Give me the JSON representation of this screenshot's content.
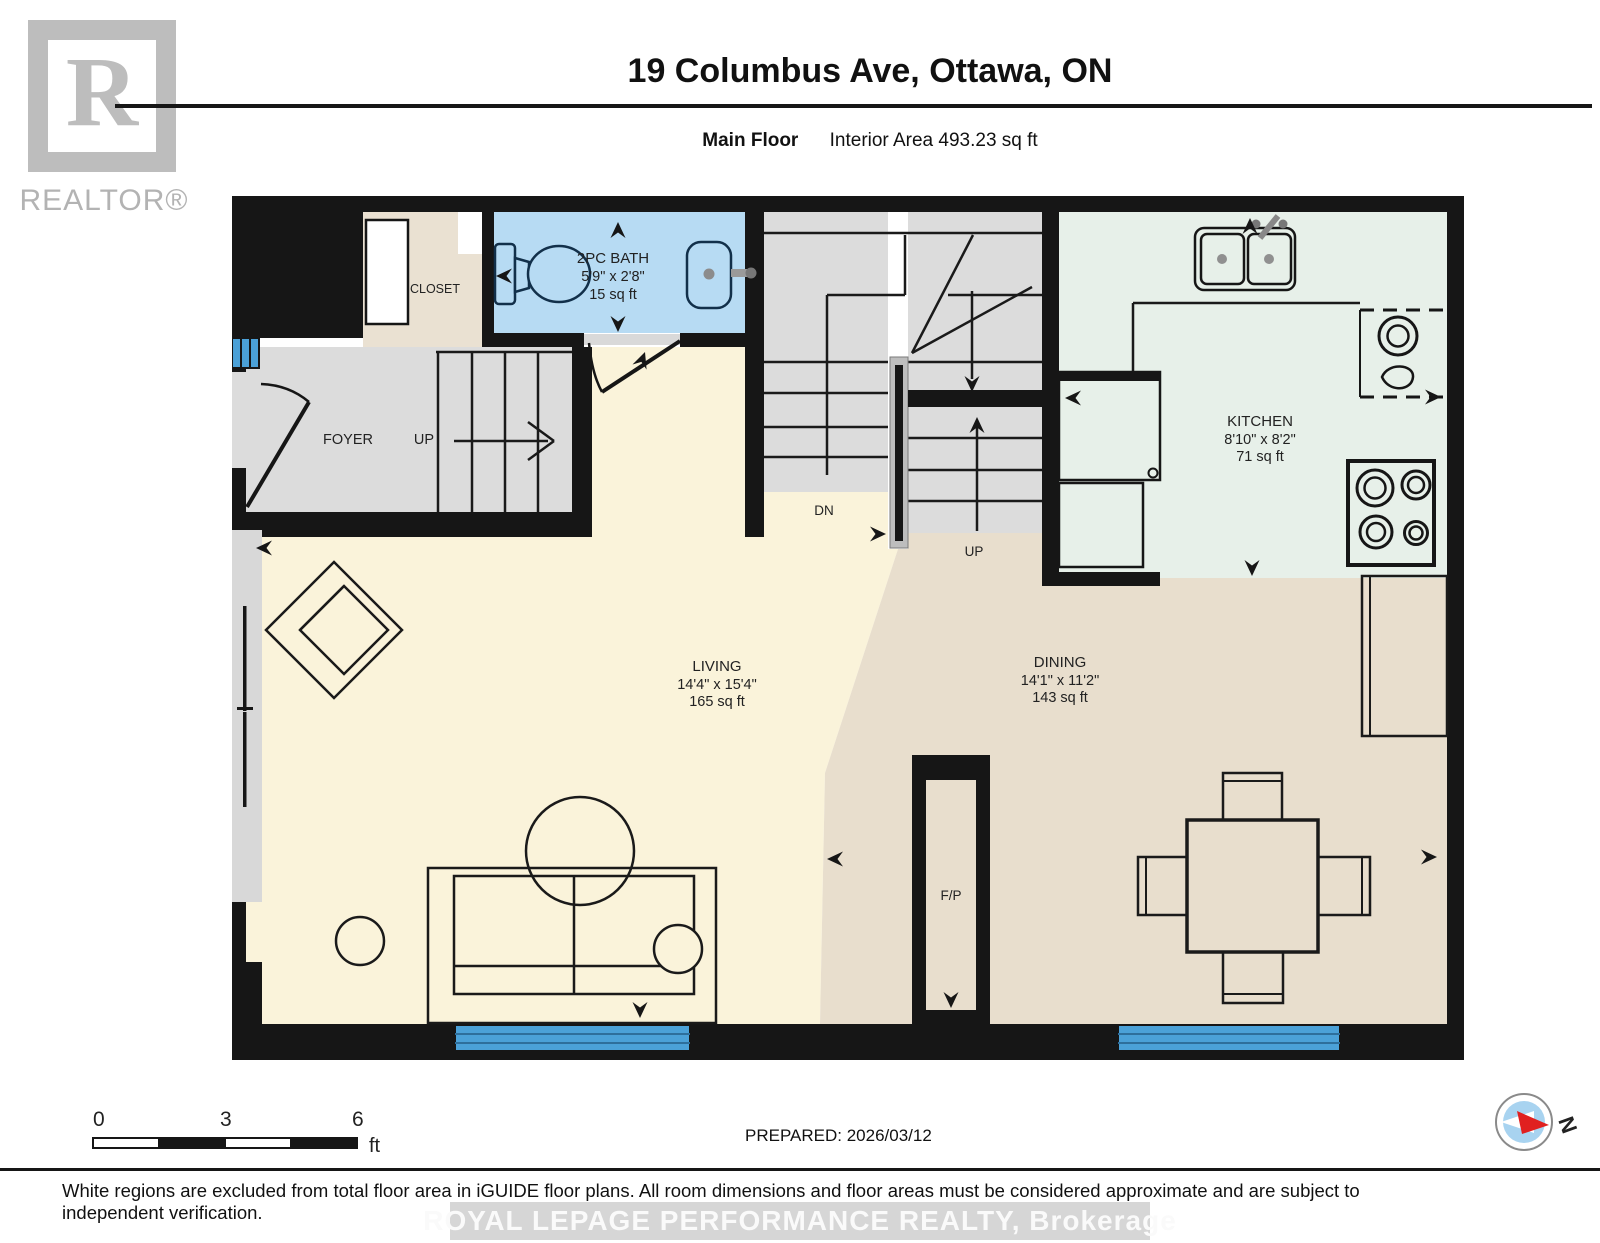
{
  "header": {
    "logo_letter": "R",
    "logo_text": "REALTOR®",
    "title": "19 Columbus Ave, Ottawa, ON",
    "floor_label": "Main Floor",
    "area_label": "Interior Area 493.23 sq ft"
  },
  "rooms": {
    "bath": {
      "name": "2PC BATH",
      "dims": "5'9\" x 2'8\"",
      "area": "15 sq ft"
    },
    "kitchen": {
      "name": "KITCHEN",
      "dims": "8'10\" x 8'2\"",
      "area": "71 sq ft"
    },
    "living": {
      "name": "LIVING",
      "dims": "14'4\" x 15'4\"",
      "area": "165 sq ft"
    },
    "dining": {
      "name": "DINING",
      "dims": "14'1\" x 11'2\"",
      "area": "143 sq ft"
    },
    "closet": {
      "name": "CLOSET"
    },
    "foyer": {
      "name": "FOYER"
    },
    "fireplace": {
      "name": "F/P"
    }
  },
  "stairs": {
    "up_foyer": "UP",
    "down_center": "DN",
    "up_center": "UP"
  },
  "scale_bar": {
    "tick0": "0",
    "tick1": "3",
    "tick2": "6",
    "unit": "ft"
  },
  "footer": {
    "prepared": "PREPARED: 2026/03/12",
    "compass_label": "N",
    "disclaimer": "White regions are excluded from total floor area in iGUIDE floor plans. All room dimensions and floor areas must be considered approximate and are subject to independent verification.",
    "watermark": "ROYAL LEPAGE PERFORMANCE REALTY, Brokerage"
  },
  "colors": {
    "wall": "#161616",
    "bath_blue": "#b7dbf3",
    "kitchen_mint": "#e7f0e9",
    "living_cream": "#faf3da",
    "dining_tan": "#e8decd",
    "window_blue": "#4ba1d8"
  }
}
